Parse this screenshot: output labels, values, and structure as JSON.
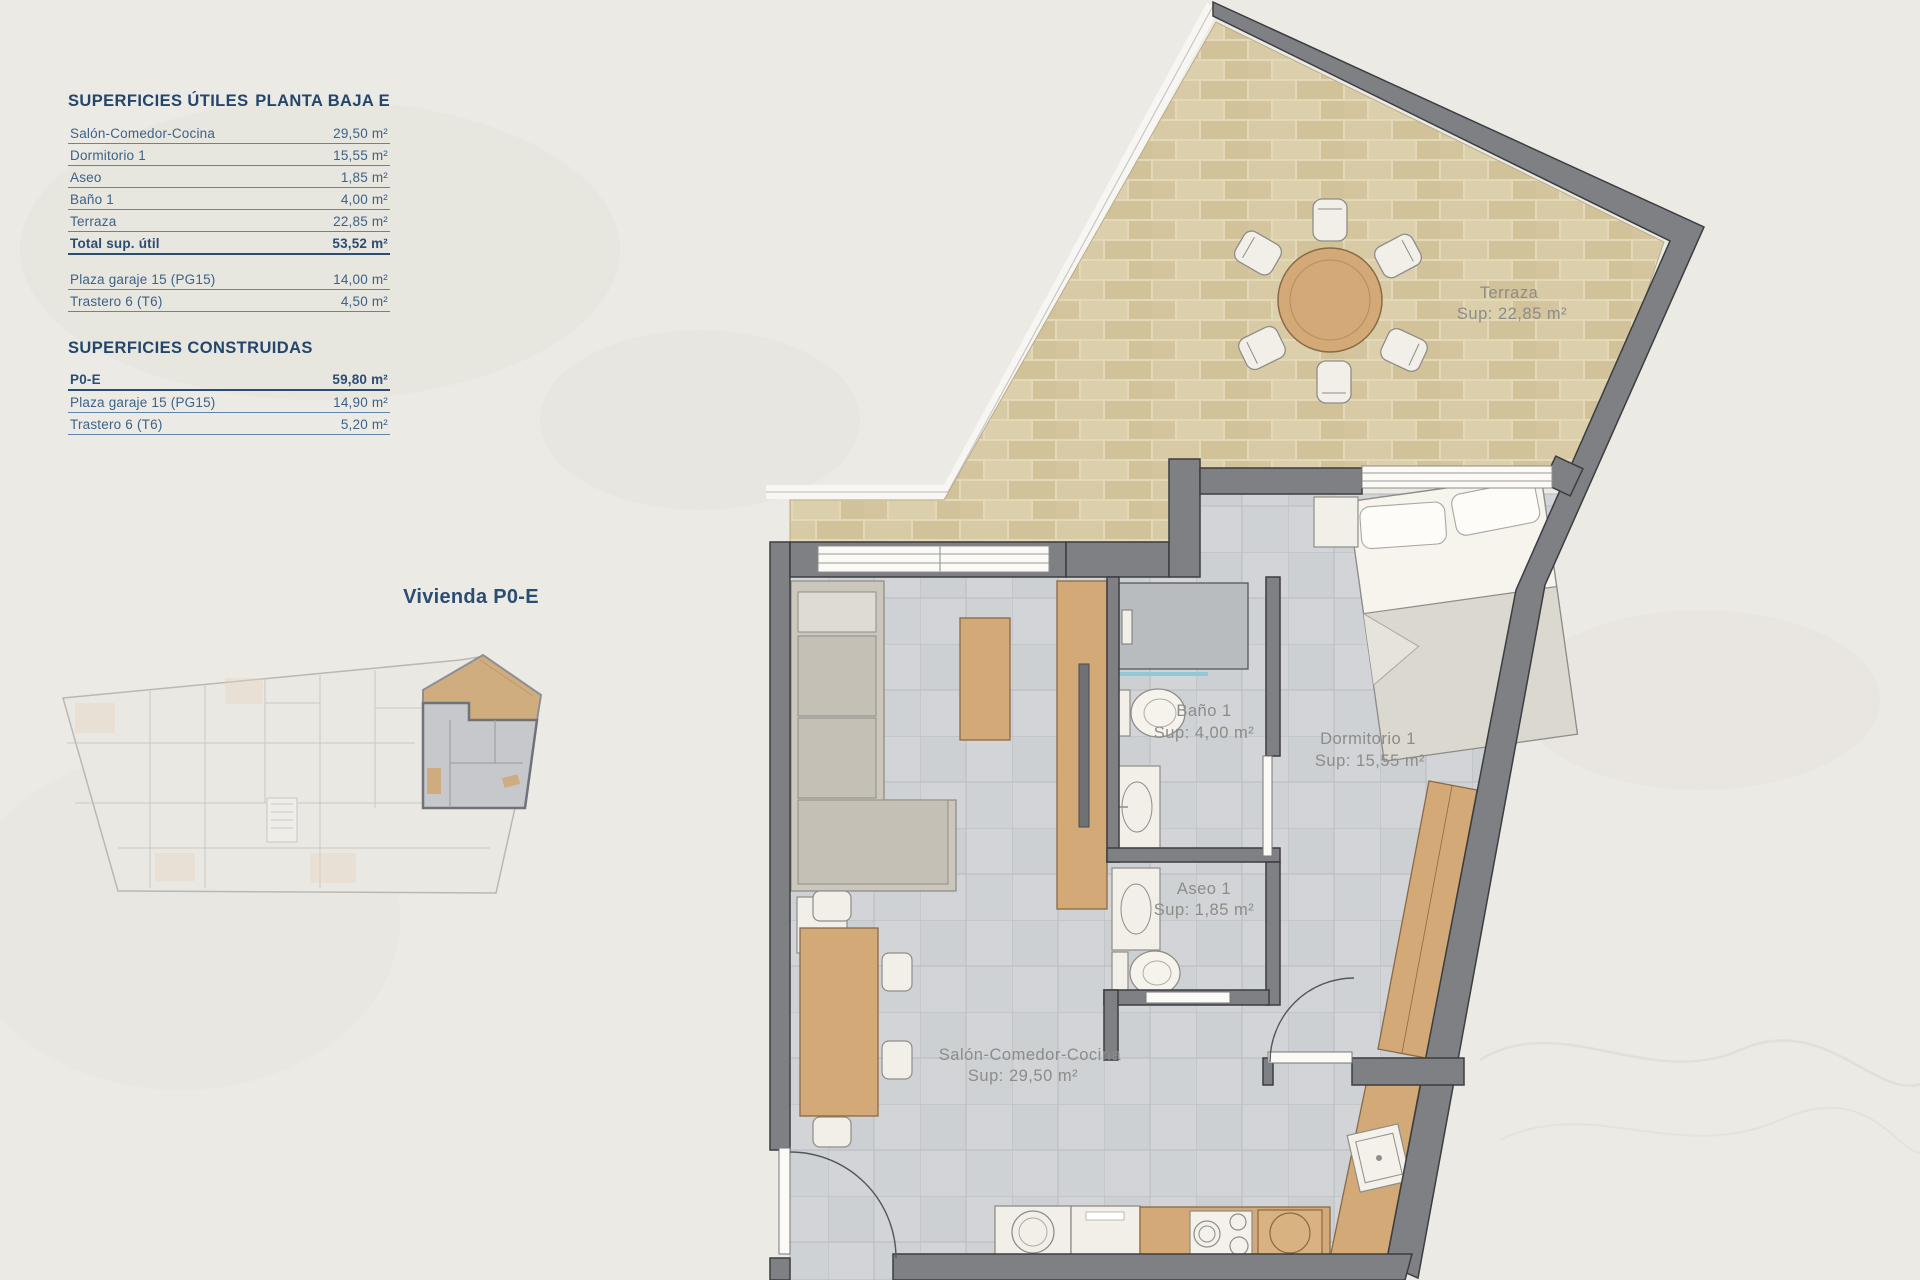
{
  "panel": {
    "titles": {
      "left": "SUPERFICIES ÚTILES",
      "right": "PLANTA BAJA E"
    },
    "utiles": {
      "rows": [
        {
          "label": "Salón-Comedor-Cocina",
          "value": "29,50 m²"
        },
        {
          "label": "Dormitorio 1",
          "value": "15,55 m²"
        },
        {
          "label": "Aseo",
          "value": "1,85 m²"
        },
        {
          "label": "Baño 1",
          "value": "4,00 m²"
        },
        {
          "label": "Terraza",
          "value": "22,85 m²"
        }
      ],
      "total": {
        "label": "Total sup. útil",
        "value": "53,52 m²"
      }
    },
    "annex": {
      "rows": [
        {
          "label": "Plaza garaje 15 (PG15)",
          "value": "14,00 m²"
        },
        {
          "label": "Trastero 6 (T6)",
          "value": "4,50 m²"
        }
      ]
    },
    "construidas": {
      "title": "SUPERFICIES CONSTRUIDAS",
      "rows": [
        {
          "label": "P0-E",
          "value": "59,80 m²"
        },
        {
          "label": "Plaza garaje 15 (PG15)",
          "value": "14,90 m²"
        },
        {
          "label": "Trastero 6 (T6)",
          "value": "5,20 m²"
        }
      ]
    }
  },
  "overview": {
    "caption": "Vivienda P0-E"
  },
  "plan": {
    "rooms": {
      "terraza": {
        "name": "Terraza",
        "area": "Sup: 22,85 m²"
      },
      "banio": {
        "name": "Baño 1",
        "area": "Sup: 4,00 m²"
      },
      "dormitorio": {
        "name": "Dormitorio 1",
        "area": "Sup: 15,55 m²"
      },
      "aseo": {
        "name": "Aseo 1",
        "area": "Sup: 1,85 m²"
      },
      "salon": {
        "name": "Salón-Comedor-Cocina",
        "area": "Sup: 29,50 m²"
      }
    }
  },
  "colors": {
    "accent_navy": "#2b4d74",
    "wall_gray": "#7e8083",
    "terrace_tan": "#d8caa4",
    "floor_gray": "#d2d4d7",
    "wood": "#d2a977",
    "label_gray": "#8c8c88"
  }
}
